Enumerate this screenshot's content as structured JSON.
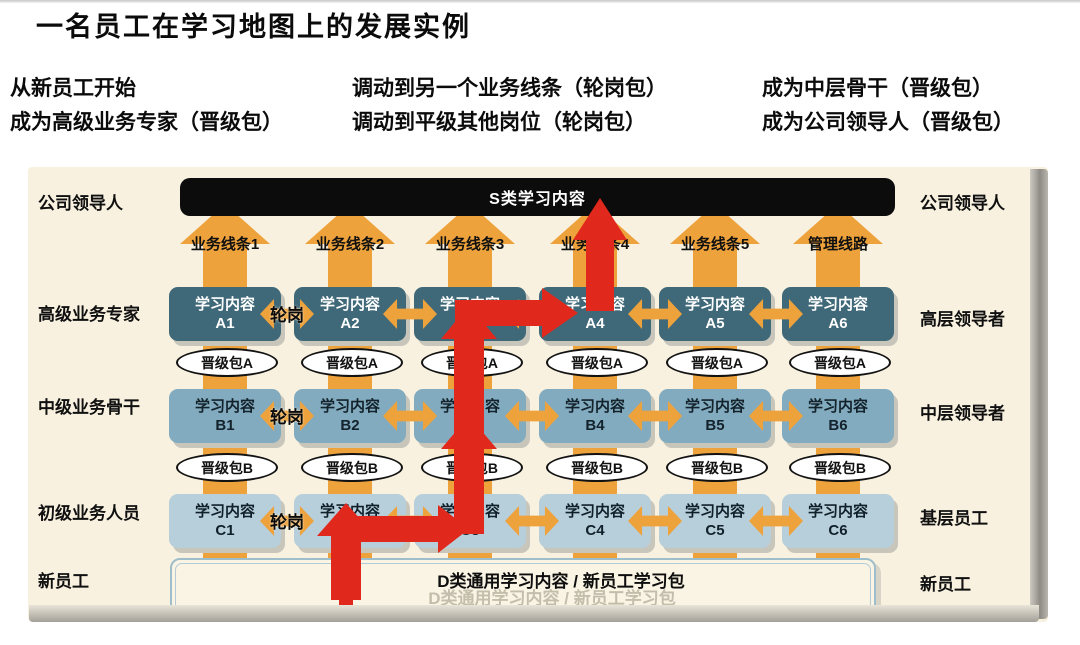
{
  "title": "一名员工在学习地图上的发展实例",
  "milestones": [
    {
      "lines": [
        "从新员工开始",
        "成为高级业务专家（晋级包）"
      ]
    },
    {
      "lines": [
        "调动到另一个业务线条（轮岗包）",
        "调动到平级其他岗位（轮岗包）"
      ]
    },
    {
      "lines": [
        "成为中层骨干（晋级包）",
        "成为公司领导人（晋级包）"
      ]
    }
  ],
  "map": {
    "top_bar_label": "S类学习内容",
    "bottom_bar_label": "D类通用学习内容 / 新员工学习包",
    "box_line1": "学习内容",
    "rotation_label": "轮岗",
    "columns": [
      "业务线条1",
      "业务线条2",
      "业务线条3",
      "业务线条4",
      "业务线条5",
      "管理线路"
    ],
    "left_labels": [
      "公司领导人",
      "高级业务专家",
      "中级业务骨干",
      "初级业务人员",
      "新员工"
    ],
    "right_labels": [
      "公司领导人",
      "高层领导者",
      "中层领导者",
      "基层员工",
      "新员工"
    ],
    "rows": [
      {
        "codes": [
          "A1",
          "A2",
          "A3",
          "A4",
          "A5",
          "A6"
        ],
        "package": "晋级包A"
      },
      {
        "codes": [
          "B1",
          "B2",
          "B3",
          "B4",
          "B5",
          "B6"
        ],
        "package": "晋级包B"
      },
      {
        "codes": [
          "C1",
          "C2",
          "C3",
          "C4",
          "C5",
          "C6"
        ]
      }
    ]
  },
  "colors": {
    "orange": "#eea23c",
    "red": "#e0281c",
    "row_a_fill": "#3f6878",
    "row_b_fill": "#82abbf",
    "row_c_fill": "#b7cedb",
    "panel_bg": "#f8f1df",
    "top_bar_bg": "#0c0c0c"
  }
}
